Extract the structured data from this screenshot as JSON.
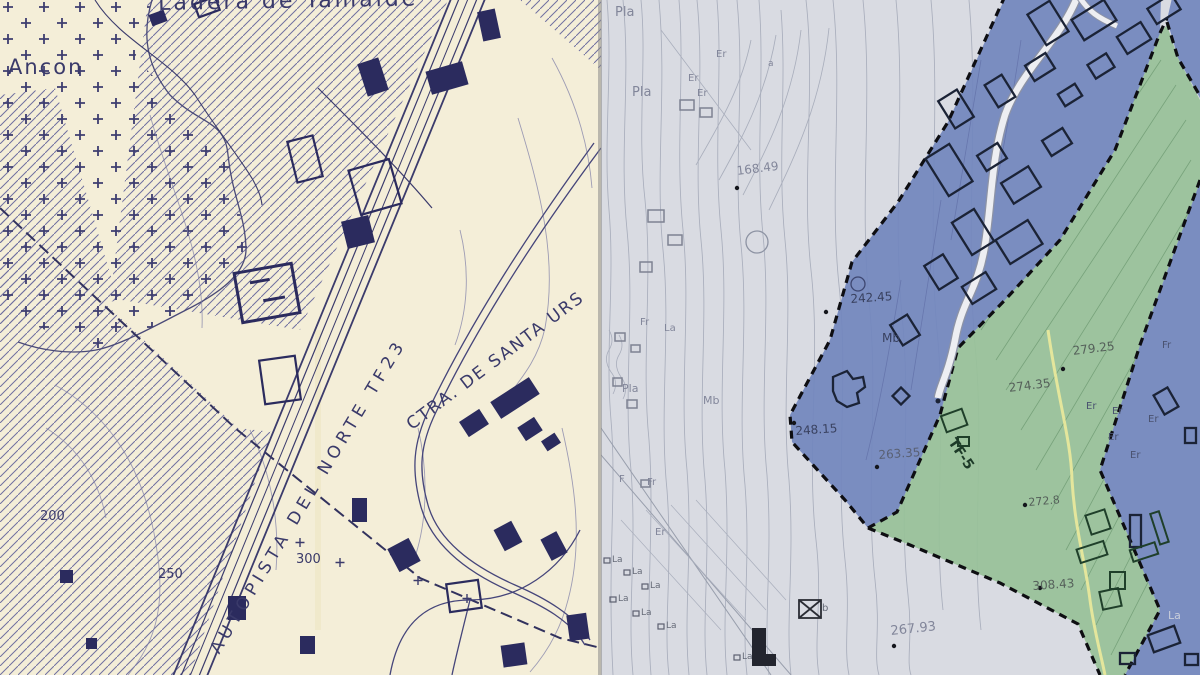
{
  "image_type": "Scanned map comparison: left cream topographic/cadastral sheet, right grey zoning plan with blue and green zones",
  "colors": {
    "left_paper": "#f4eed8",
    "left_ink": "#3a3a6a",
    "left_building": "#2b2b5e",
    "right_paper": "#d9dbe2",
    "right_contour": "#a9aebc",
    "blue_zone": "#7287bd",
    "green_zone": "#98c198",
    "boundary_dash": "#0e0e12",
    "yellow_line": "#e8e89c",
    "road_white": "#edeef2"
  },
  "left_panel": {
    "description": "cream topographic map with diagonal hatching, cross-symbol field, motorway and buildings",
    "labels": [
      {
        "name": "place-label-ladera",
        "text": "Ladera de Tamaide",
        "x": 158,
        "y": -7,
        "size": 22,
        "ls": 3,
        "rot": -1,
        "color": "#3a3a6a"
      },
      {
        "name": "place-label-ancon",
        "text": "Ancon",
        "x": 8,
        "y": 57,
        "size": 21,
        "ls": 2,
        "color": "#3a3a6a"
      },
      {
        "name": "road-label-autopista",
        "text": "AUTOPISTA DEL NORTE TF23",
        "x": 208,
        "y": 648,
        "size": 17,
        "ls": 5,
        "rot": -59,
        "color": "#3a3a6a"
      },
      {
        "name": "road-label-ctra-santa-ursula",
        "text": "CTRA. DE SANTA URS",
        "x": 404,
        "y": 420,
        "size": 17,
        "ls": 2,
        "rot": -37,
        "color": "#3a3a6a"
      },
      {
        "name": "contour-label-200",
        "text": "200",
        "x": 40,
        "y": 510,
        "size": 13,
        "color": "#3a3a6a"
      },
      {
        "name": "contour-label-250",
        "text": "250",
        "x": 158,
        "y": 568,
        "size": 13,
        "color": "#3a3a6a"
      },
      {
        "name": "contour-label-300",
        "text": "300",
        "x": 296,
        "y": 553,
        "size": 13,
        "color": "#3a3a6a"
      }
    ]
  },
  "right_panel": {
    "description": "grey zoning plan with contour lines, blue urban zones bounded by black dashes, green band with TF-5 label",
    "labels": [
      {
        "name": "soil-label-pla",
        "text": "Pla",
        "x": 14,
        "y": 6,
        "size": 13,
        "color": "#82869a"
      },
      {
        "name": "soil-label-pla",
        "text": "Pla",
        "x": 31,
        "y": 86,
        "size": 13,
        "color": "#82869a"
      },
      {
        "name": "soil-label-er",
        "text": "Er",
        "x": 115,
        "y": 50,
        "size": 10,
        "color": "#82869a"
      },
      {
        "name": "soil-label-er",
        "text": "Er",
        "x": 87,
        "y": 74,
        "size": 10,
        "color": "#82869a"
      },
      {
        "name": "soil-label-er",
        "text": "Er",
        "x": 96,
        "y": 89,
        "size": 10,
        "color": "#82869a"
      },
      {
        "name": "soil-label-a",
        "text": "a",
        "x": 167,
        "y": 60,
        "size": 9,
        "color": "#82869a"
      },
      {
        "name": "elevation-label",
        "text": "168.49",
        "x": 135,
        "y": 165,
        "size": 12,
        "rot": -7,
        "color": "#82869a"
      },
      {
        "name": "elevation-label",
        "text": "242.45",
        "x": 249,
        "y": 293,
        "size": 12,
        "rot": -4,
        "color": "#39415f"
      },
      {
        "name": "soil-label-mb",
        "text": "Mb",
        "x": 281,
        "y": 332,
        "size": 12,
        "color": "#39415f"
      },
      {
        "name": "soil-label-mb",
        "text": "Mb",
        "x": 102,
        "y": 395,
        "size": 11,
        "color": "#82869a"
      },
      {
        "name": "soil-label-fr",
        "text": "Fr",
        "x": 39,
        "y": 318,
        "size": 10,
        "color": "#82869a"
      },
      {
        "name": "soil-label-la",
        "text": "La",
        "x": 63,
        "y": 324,
        "size": 10,
        "color": "#82869a"
      },
      {
        "name": "soil-label-pla",
        "text": "Pla",
        "x": 21,
        "y": 383,
        "size": 11,
        "color": "#82869a"
      },
      {
        "name": "soil-label-f",
        "text": "F",
        "x": 18,
        "y": 475,
        "size": 10,
        "color": "#82869a"
      },
      {
        "name": "soil-label-fr",
        "text": "Fr",
        "x": 46,
        "y": 478,
        "size": 10,
        "color": "#82869a"
      },
      {
        "name": "soil-label-er",
        "text": "Er",
        "x": 54,
        "y": 528,
        "size": 10,
        "color": "#82869a"
      },
      {
        "name": "elevation-label",
        "text": "248.15",
        "x": 194,
        "y": 425,
        "size": 12,
        "rot": -4,
        "color": "#39415f"
      },
      {
        "name": "elevation-label",
        "text": "263.35",
        "x": 277,
        "y": 449,
        "size": 12,
        "rot": -4,
        "color": "#596073"
      },
      {
        "name": "zone-label-tf5",
        "text": "TF-5",
        "x": 356,
        "y": 436,
        "size": 14,
        "rot": 56,
        "cls": "tf5"
      },
      {
        "name": "elevation-label",
        "text": "274.35",
        "x": 407,
        "y": 382,
        "size": 12,
        "rot": -7,
        "color": "#55605a"
      },
      {
        "name": "elevation-label",
        "text": "279.25",
        "x": 471,
        "y": 345,
        "size": 12,
        "rot": -7,
        "color": "#55605a"
      },
      {
        "name": "elevation-label",
        "text": "272.8",
        "x": 427,
        "y": 497,
        "size": 11,
        "rot": -5,
        "color": "#55605a"
      },
      {
        "name": "elevation-label",
        "text": "308.43",
        "x": 431,
        "y": 580,
        "size": 12,
        "rot": -4,
        "color": "#55605a"
      },
      {
        "name": "elevation-label",
        "text": "267.93",
        "x": 289,
        "y": 625,
        "size": 13,
        "rot": -6,
        "color": "#82869a"
      },
      {
        "name": "soil-label-er",
        "text": "Er",
        "x": 485,
        "y": 402,
        "size": 10,
        "color": "#4a5270"
      },
      {
        "name": "soil-label-er",
        "text": "Er",
        "x": 511,
        "y": 407,
        "size": 10,
        "color": "#4a5270"
      },
      {
        "name": "soil-label-er",
        "text": "Er",
        "x": 547,
        "y": 415,
        "size": 10,
        "color": "#4a5270"
      },
      {
        "name": "soil-label-er",
        "text": "Er",
        "x": 507,
        "y": 433,
        "size": 10,
        "color": "#4a5270"
      },
      {
        "name": "soil-label-er",
        "text": "Er",
        "x": 529,
        "y": 451,
        "size": 10,
        "color": "#4a5270"
      },
      {
        "name": "soil-label-fr",
        "text": "Fr",
        "x": 561,
        "y": 341,
        "size": 10,
        "color": "#4a5270"
      },
      {
        "name": "soil-label-la",
        "text": "La",
        "x": 567,
        "y": 610,
        "size": 11,
        "color": "#c8cdda"
      },
      {
        "name": "soil-label-la",
        "text": "La",
        "x": 11,
        "y": 556,
        "size": 9,
        "color": "#666b78"
      },
      {
        "name": "soil-label-la",
        "text": "La",
        "x": 31,
        "y": 568,
        "size": 9,
        "color": "#666b78"
      },
      {
        "name": "soil-label-la",
        "text": "La",
        "x": 49,
        "y": 582,
        "size": 9,
        "color": "#666b78"
      },
      {
        "name": "soil-label-la",
        "text": "La",
        "x": 17,
        "y": 595,
        "size": 9,
        "color": "#666b78"
      },
      {
        "name": "soil-label-la",
        "text": "La",
        "x": 40,
        "y": 609,
        "size": 9,
        "color": "#666b78"
      },
      {
        "name": "soil-label-la",
        "text": "La",
        "x": 65,
        "y": 622,
        "size": 9,
        "color": "#666b78"
      },
      {
        "name": "soil-label-la",
        "text": "La",
        "x": 141,
        "y": 653,
        "size": 9,
        "color": "#666b78"
      },
      {
        "name": "symbol-label-b",
        "text": "b",
        "x": 221,
        "y": 604,
        "size": 10,
        "color": "#666b78"
      }
    ]
  }
}
